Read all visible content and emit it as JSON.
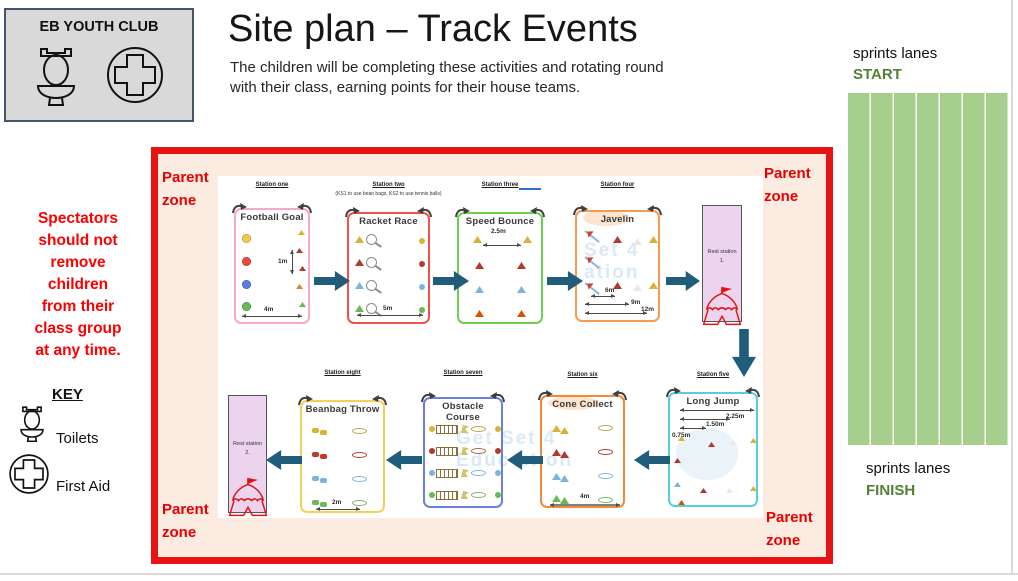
{
  "header": {
    "club_title": "EB YOUTH CLUB",
    "title": "Site plan – Track Events",
    "subtitle": "The children will be completing these activities and rotating round\nwith their class, earning points for their house teams."
  },
  "left_panel": {
    "notice": "Spectators\nshould not\nremove\nchildren\nfrom their\nclass group\nat any time.",
    "key_title": "KEY",
    "key_items": [
      {
        "icon": "toilet-icon",
        "label": "Toilets"
      },
      {
        "icon": "first-aid-icon",
        "label": "First Aid"
      }
    ]
  },
  "site_map": {
    "parent_zone": "Parent zone",
    "watermark": {
      "top": "Set 4\nation",
      "bottom": "Get Set 4\nEduc ation"
    },
    "stations": [
      {
        "label": "Station one",
        "name": "Football Goal",
        "border": "#f9a7ce",
        "m_v": "1m",
        "m_b": "4m"
      },
      {
        "label": "Station two",
        "name": "Racket Race",
        "border": "#f0524a",
        "note": "(KS1 to use bean bags, KS2 to use tennis balls)",
        "m_b": "5m"
      },
      {
        "label": "Station three",
        "name": "Speed Bounce",
        "border": "#6ecf4e",
        "m_t": "2.5m"
      },
      {
        "label": "Station four",
        "name": "Javelin",
        "border": "#f59a52",
        "d1": "6m",
        "d2": "9m",
        "d3": "12m"
      },
      {
        "label": "Station five",
        "name": "Long Jump",
        "border": "#55cde2",
        "d1": "2.25m",
        "d2": "1.50m",
        "d3": "0.75m"
      },
      {
        "label": "Station six",
        "name": "Cone Collect",
        "border": "#ef8a3a",
        "m_b": "4m"
      },
      {
        "label": "Station seven",
        "name": "Obstacle Course",
        "border": "#6b80d8"
      },
      {
        "label": "Station eight",
        "name": "Beanbag Throw",
        "border": "#f6cf56",
        "m_b": "2m"
      }
    ],
    "rest_stations": [
      {
        "text": "Rest station\n1."
      },
      {
        "text": "Rest station\n2."
      }
    ]
  },
  "sprint_lanes": {
    "top_label": "sprints lanes",
    "start": "START",
    "bottom_label": "sprints lanes",
    "finish": "FINISH",
    "lane_count": 7
  },
  "colors": {
    "box_border_red": "#e81414",
    "zone_fill": "#fcebe1",
    "lane_green": "#a6ce8c",
    "green_text": "#538135",
    "arrow_blue": "#205d7b",
    "club_box_gray": "#d9d9d9"
  }
}
